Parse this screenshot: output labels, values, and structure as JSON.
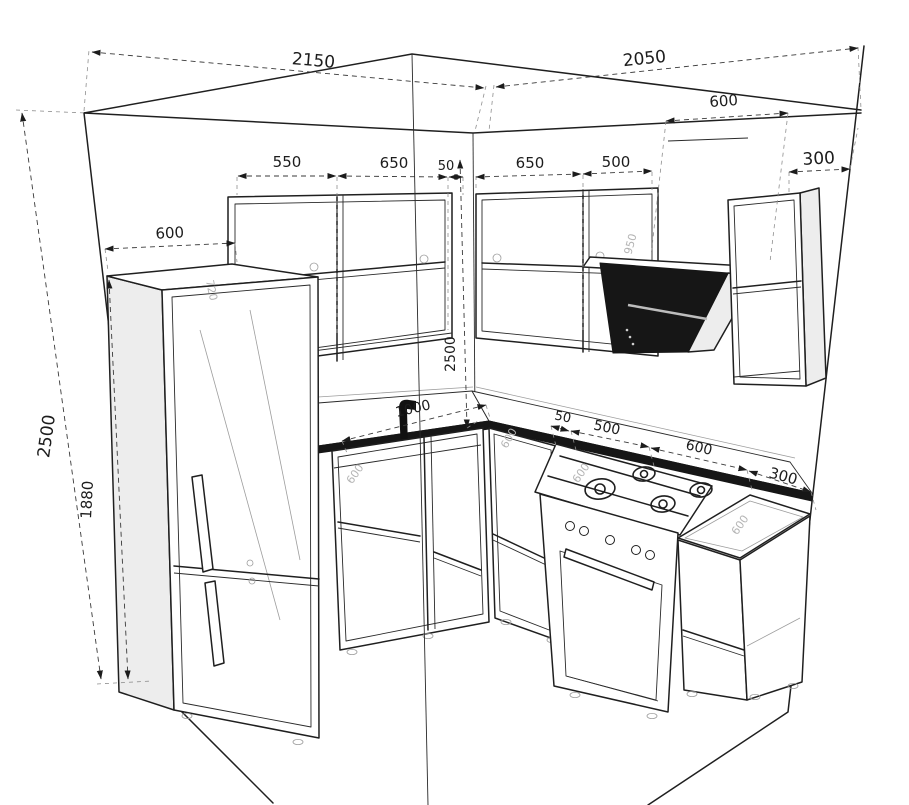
{
  "drawing_title": "corner-kitchen-dimension-drawing",
  "colors": {
    "line": "#1f1f1f",
    "light_line": "#9d9d9d",
    "faint_label": "#b4b4b4",
    "dark_fill": "#161616",
    "side_fill": "#ededed",
    "background": "#ffffff"
  },
  "dimensions": {
    "left_wall_width": "2150",
    "right_wall_width": "2050",
    "room_height": "2500",
    "fridge_height": "1880",
    "fridge_section_width": "600",
    "upper_left_cab_1": "550",
    "upper_left_cab_2": "650",
    "upper_left_gap": "50",
    "upper_right_cab_1": "650",
    "upper_right_cab_2": "500",
    "hood_width": "600",
    "upper_right_open_cab": "300",
    "corner_height": "2500",
    "sink_offset": "1000",
    "base_gap": "50",
    "base_stove_section": "500",
    "base_counter_section": "600",
    "base_end_section": "300"
  },
  "surface_labels": {
    "fridge_top_depth": "720",
    "hood_height": "950",
    "counter_depth_sink": "600",
    "counter_depth_corner": "600",
    "counter_depth_stove": "600",
    "counter_depth_right": "600"
  }
}
